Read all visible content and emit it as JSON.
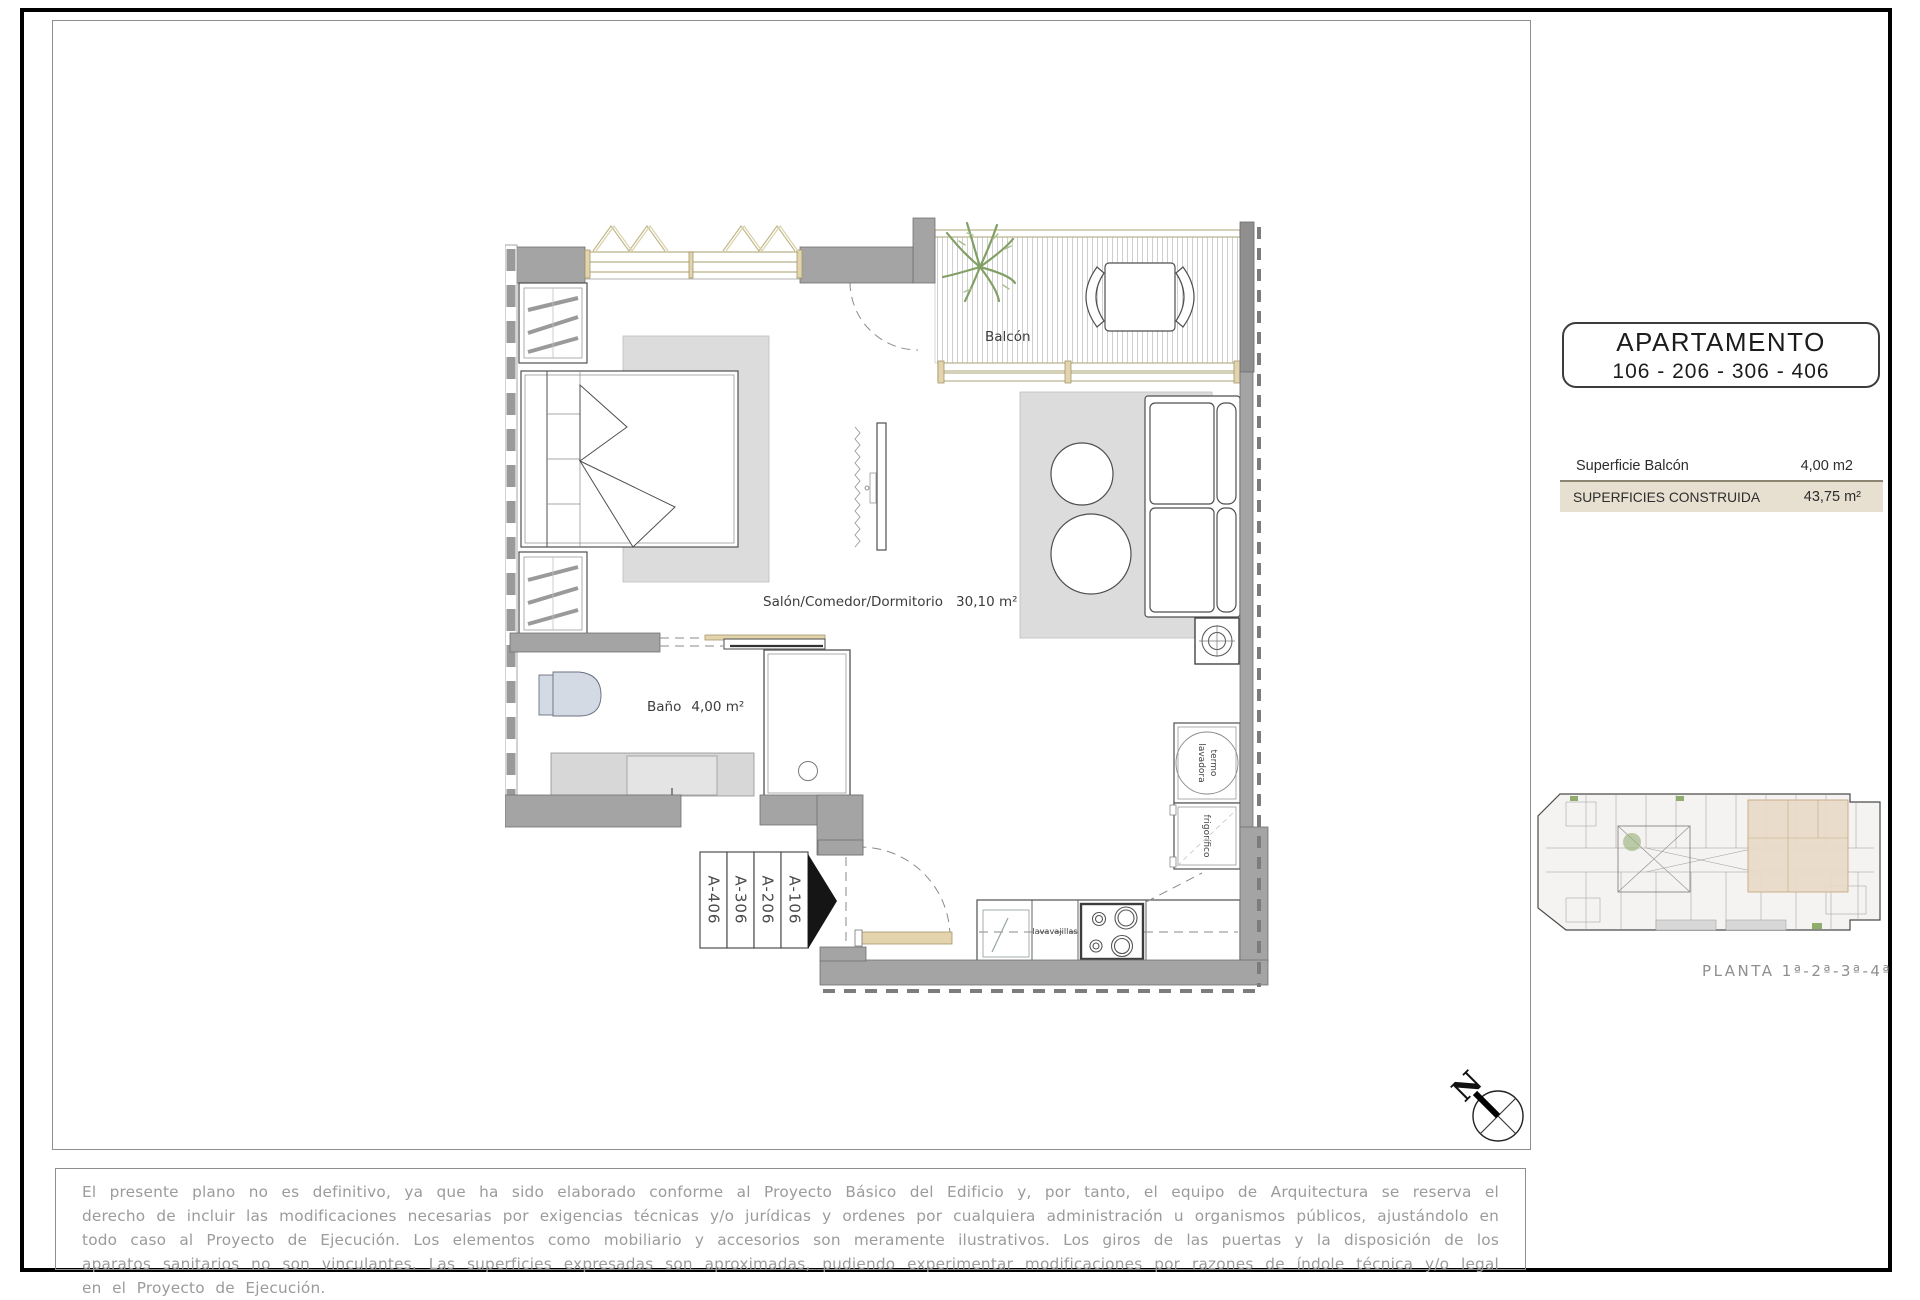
{
  "sidebar": {
    "apartment_title": "APARTAMENTO",
    "apartment_numbers": "106 - 206 - 306 - 406",
    "table": {
      "row1_label": "Superficie Balcón",
      "row1_value": "4,00 m2",
      "row2_label": "SUPERFICIES CONSTRUIDA",
      "row2_value": "43,75 m²"
    },
    "key_plan_caption": "PLANTA 1ª-2ª-3ª-4ª"
  },
  "plan": {
    "balcony_label": "Balcón",
    "living_label": "Salón/Comedor/Dormitorio",
    "living_area": "30,10 m²",
    "bath_label": "Baño",
    "bath_area": "4,00 m²",
    "dishwasher_label": "lavavajillas",
    "heater_label": "termo",
    "washer_label": "lavadora",
    "fridge_label": "frigorífico",
    "unit_tags": [
      "A-406",
      "A-306",
      "A-206",
      "A-106"
    ],
    "north_label": "N"
  },
  "disclaimer": "El presente plano no es definitivo, ya que ha sido elaborado conforme al Proyecto Básico del Edificio y, por tanto, el equipo de Arquitectura se reserva el derecho de incluir las modificaciones necesarias por exigencias técnicas y/o jurídicas y ordenes por cualquiera administración u organismos públicos, ajustándolo en todo caso al Proyecto de Ejecución. Los elementos como mobiliario y accesorios son meramente ilustrativos. Los giros de las puertas y la disposición de los aparatos sanitarios no son vinculantes. Las superficies expresadas son aproximadas, pudiendo experimentar modificaciones por razones de índole técnica y/o legal en el Proyecto de Ejecución.",
  "colors": {
    "wall": "#a4a4a4",
    "wall-dark": "#8f8f8f",
    "rug": "#dcdcdc",
    "wood": "#e3d4ae",
    "wood-line": "#b9b08a",
    "plant": "#82a065",
    "fixture": "#d4dae4",
    "accent-row": "#e7e0d1",
    "highlight-unit": "#e9dbc8",
    "cad-text": "#9b9b9b"
  }
}
